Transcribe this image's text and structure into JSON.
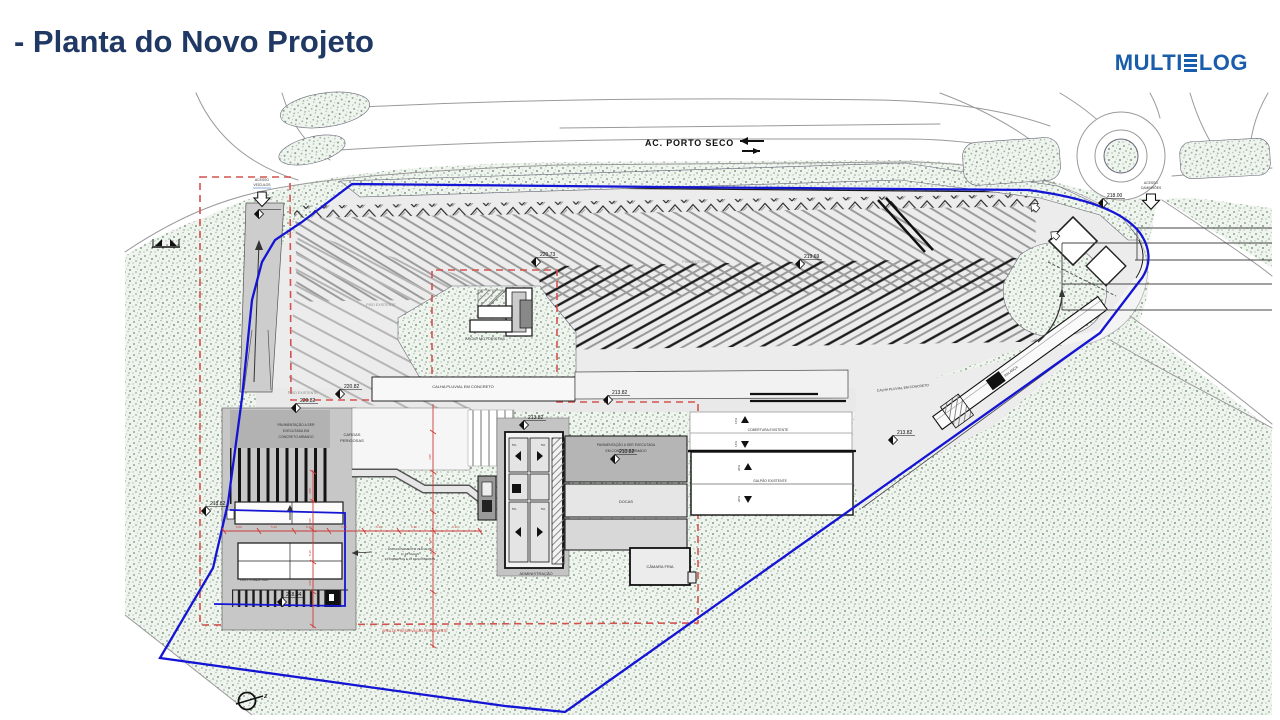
{
  "header": {
    "title": "- Planta do Novo Projeto"
  },
  "logo": {
    "part1": "MULTI",
    "part2": "LOG"
  },
  "plan": {
    "road_label": "AC. PORTO SECO",
    "access_vehicles": [
      "ACESSO",
      "VEÍCULOS"
    ],
    "access_trucks": [
      "ACESSO",
      "CAMINHÕES"
    ],
    "labels": {
      "piso_existente": "PISO EXISTENTE",
      "apoio_motoristas": "APOIO MOTORISTAS",
      "calha_pluvial": "CALHA PLUVIAL EM CONCRETO",
      "pav_l1": "PAVIMENTAÇÃO A SER",
      "pav_l2": "EXECUTADA EM",
      "pav_l3": "CONCRETO ARMADO",
      "pav_c1": "PAVIMENTAÇÃO A SER EXECUTADA",
      "pav_c2": "EM CONCRETO ARMADO",
      "cargas1": "CARGAS",
      "cargas2": "PERIGOSAS",
      "docas": "DOCAS",
      "camara_fria": "CÂMARA FRIA",
      "administracao": "ADMINISTRAÇÃO",
      "cobertura_existente": "COBERTURA EXISTENTE",
      "galpao_existente": "GALPÃO EXISTENTE",
      "balanca": "BALANÇA",
      "proj_cobertura": "PROJ. COBERTURA",
      "est1": "ESTACIONAMENTO VEÍCULOS",
      "est2": "C/ 48 VAGAS",
      "est3": "33 COBERTAS E 15 DESCOBERTAS",
      "preservacao": "ÁREA DE PRESERVAÇÃO PERMANENTE",
      "slope14": "14%",
      "slope20": "20%",
      "slope5": "5%",
      "north_z": "z"
    },
    "elevations": {
      "e1": "220.73",
      "e2": "219.69",
      "e3": "220.82",
      "e4": "220.82",
      "e5": "213.82",
      "e6": "213.82",
      "e7": "213.82",
      "e8": "213.82",
      "e9": "218.00",
      "e10": "218.82",
      "e11": "218.34"
    },
    "dimensions": {
      "h": [
        "5.00",
        "5.40",
        "5.40",
        "7.00",
        "5.40",
        "5.40",
        "3.30"
      ],
      "v": [
        "4.85",
        "4.85",
        "5.35",
        "4.85"
      ]
    },
    "colors": {
      "boundary_blue": "#1414d4",
      "dashed_red": "#d4524e",
      "terrain_green": "#7fa080",
      "title_navy": "#1f3864",
      "logo_blue": "#1a5dab"
    }
  }
}
